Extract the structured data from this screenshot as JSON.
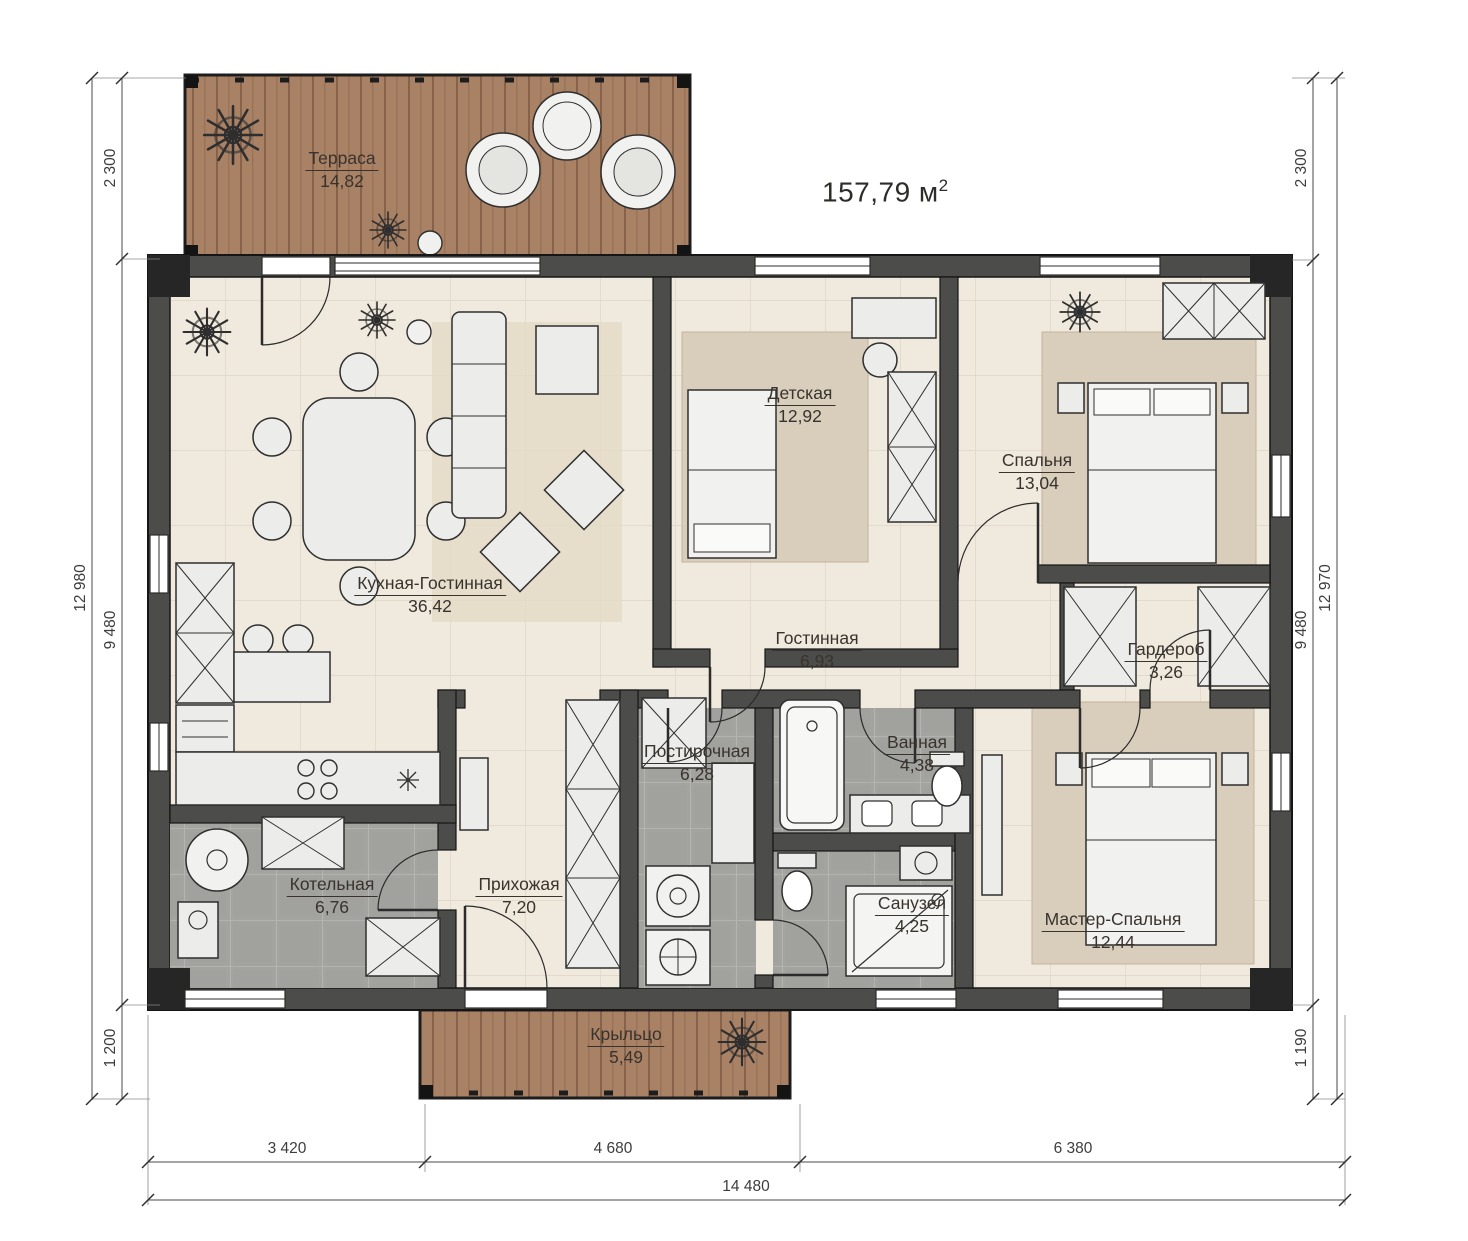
{
  "title": {
    "total_area_value": "157,79",
    "total_area_unit": "м",
    "total_area_sup": "2"
  },
  "rooms": {
    "terrace": {
      "name": "Терраса",
      "area": "14,82"
    },
    "kitchen_living": {
      "name": "Кухная-Гостинная",
      "area": "36,42"
    },
    "children": {
      "name": "Детская",
      "area": "12,92"
    },
    "bedroom": {
      "name": "Спальня",
      "area": "13,04"
    },
    "living": {
      "name": "Гостинная",
      "area": "6,93"
    },
    "wardrobe": {
      "name": "Гардероб",
      "area": "3,26"
    },
    "laundry": {
      "name": "Постирочная",
      "area": "6,28"
    },
    "bath": {
      "name": "Ванная",
      "area": "4,38"
    },
    "boiler": {
      "name": "Котельная",
      "area": "6,76"
    },
    "hallway": {
      "name": "Прихожая",
      "area": "7,20"
    },
    "wc": {
      "name": "Санузел",
      "area": "4,25"
    },
    "master": {
      "name": "Мастер-Спальня",
      "area": "12,44"
    },
    "porch": {
      "name": "Крыльцо",
      "area": "5,49"
    }
  },
  "dimensions": {
    "left": {
      "overall": "12 980",
      "top": "2 300",
      "middle": "9 480",
      "bottom": "1 200"
    },
    "right": {
      "overall": "12 970",
      "top": "2 300",
      "middle": "9 480",
      "bottom": "1 190"
    },
    "bottom": {
      "overall": "14 480",
      "left": "3 420",
      "center": "4 680",
      "right": "6 380"
    }
  },
  "icons": {
    "plant": "✳"
  },
  "colors": {
    "wall": "#4c4c4a",
    "wood": "#a98266",
    "floor_cream": "#f0e9dd",
    "floor_gray": "#a3a3a0",
    "rug": "#d9cdbb",
    "furniture": "#ececea",
    "line": "#2b2b2b"
  }
}
